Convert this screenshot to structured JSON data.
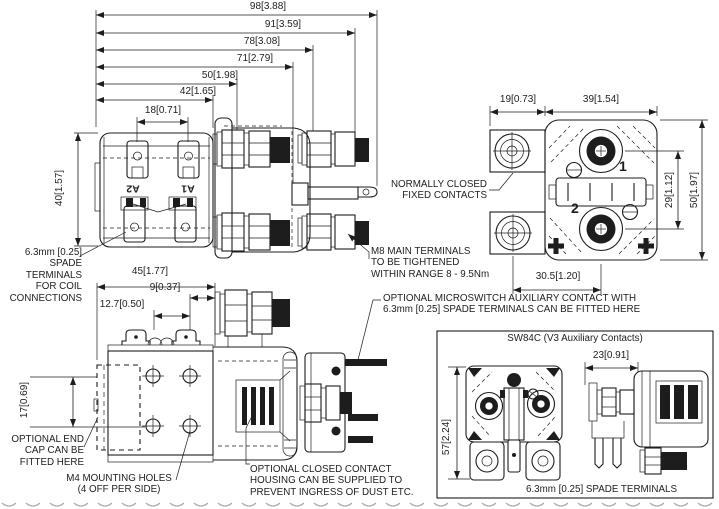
{
  "meta": {
    "bg": "#ffffff",
    "ink": "#1d1d1d",
    "scallop": "#aaaaaa"
  },
  "dims": {
    "top_98": "98[3.88]",
    "top_91": "91[3.59]",
    "top_78": "78[3.08]",
    "top_71": "71[2.79]",
    "top_50": "50[1.98]",
    "top_42": "42[1.65]",
    "top_18": "18[0.71]",
    "front_height_40": "40[1.57]",
    "end_19": "19[0.73]",
    "end_39": "39[1.54]",
    "end_29": "29[1.12]",
    "end_50": "50[1.97]",
    "end_30_5": "30.5[1.20]",
    "bottom_45": "45[1.77]",
    "bottom_9": "9[0.37]",
    "bottom_12_7": "12.7[0.50]",
    "bottom_17": "17[0.69]",
    "inset_23": "23[0.91]",
    "inset_57": "57[2.24]"
  },
  "terminal_marks": {
    "a2": "A2",
    "a1": "A1",
    "contact1": "1",
    "contact2": "2"
  },
  "labels": {
    "coil_terminals": "6.3mm [0.25]\nSPADE\nTERMINALS\nFOR COIL\nCONNECTIONS",
    "nc_contacts": "NORMALLY CLOSED\nFIXED CONTACTS",
    "m8_terminals": "M8 MAIN TERMINALS\nTO BE TIGHTENED\nWITHIN RANGE 8 - 9.5Nm",
    "microswitch": "OPTIONAL MICROSWITCH AUXILIARY CONTACT WITH\n6.3mm [0.25] SPADE TERMINALS CAN BE FITTED HERE",
    "end_cap": "OPTIONAL END\nCAP CAN BE\nFITTED HERE",
    "m4_holes": "M4 MOUNTING HOLES\n(4 OFF PER SIDE)",
    "contact_housing": "OPTIONAL CLOSED CONTACT\nHOUSING CAN BE SUPPLIED TO\nPREVENT INGRESS OF DUST ETC.",
    "inset_title": "SW84C (V3 Auxiliary Contacts)",
    "inset_spade_terminals": "6.3mm [0.25] SPADE TERMINALS"
  }
}
